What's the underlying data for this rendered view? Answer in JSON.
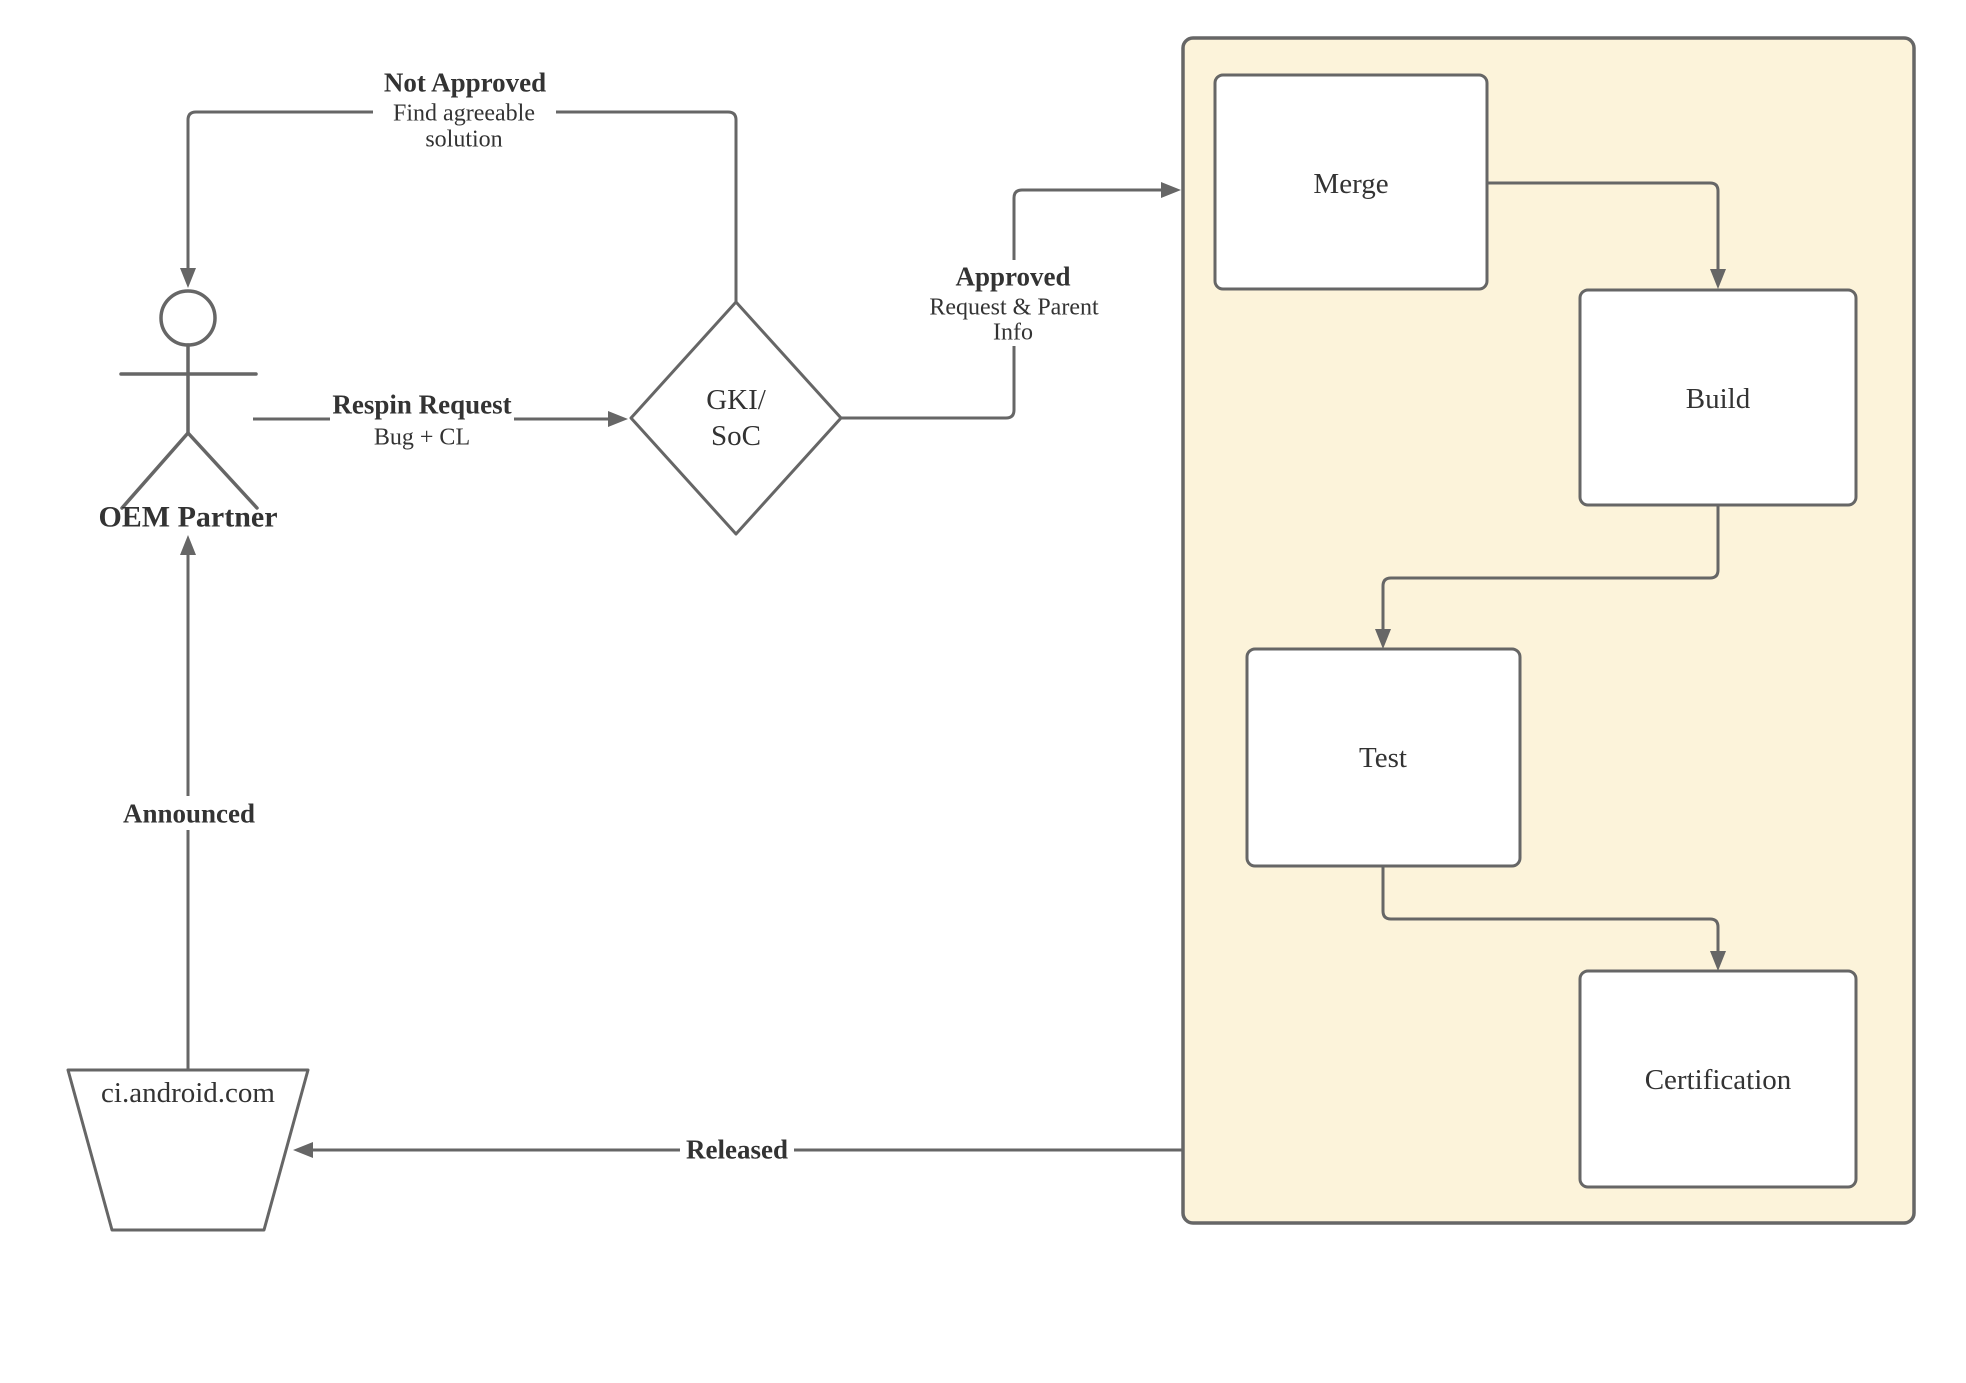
{
  "diagram": {
    "colors": {
      "background": "#ffffff",
      "stroke": "#666666",
      "text": "#333333",
      "node_fill": "#ffffff",
      "container_fill": "#FCF3DA"
    },
    "nodes": {
      "oem_partner": {
        "label": "OEM Partner",
        "type": "actor"
      },
      "gki_soc": {
        "label_line1": "GKI/",
        "label_line2": "SoC",
        "type": "decision-diamond"
      },
      "ci_android": {
        "label": "ci.android.com",
        "type": "trapezoid"
      },
      "merge": {
        "label": "Merge"
      },
      "build": {
        "label": "Build"
      },
      "test": {
        "label": "Test"
      },
      "certification": {
        "label": "Certification"
      }
    },
    "edges": {
      "respin_request": {
        "title": "Respin Request",
        "subtitle": "Bug + CL"
      },
      "not_approved": {
        "title": "Not Approved",
        "subtitle_line1": "Find agreeable",
        "subtitle_line2": "solution"
      },
      "approved": {
        "title": "Approved",
        "subtitle_line1": "Request & Parent",
        "subtitle_line2": "Info"
      },
      "announced": {
        "title": "Announced"
      },
      "released": {
        "title": "Released"
      }
    }
  }
}
